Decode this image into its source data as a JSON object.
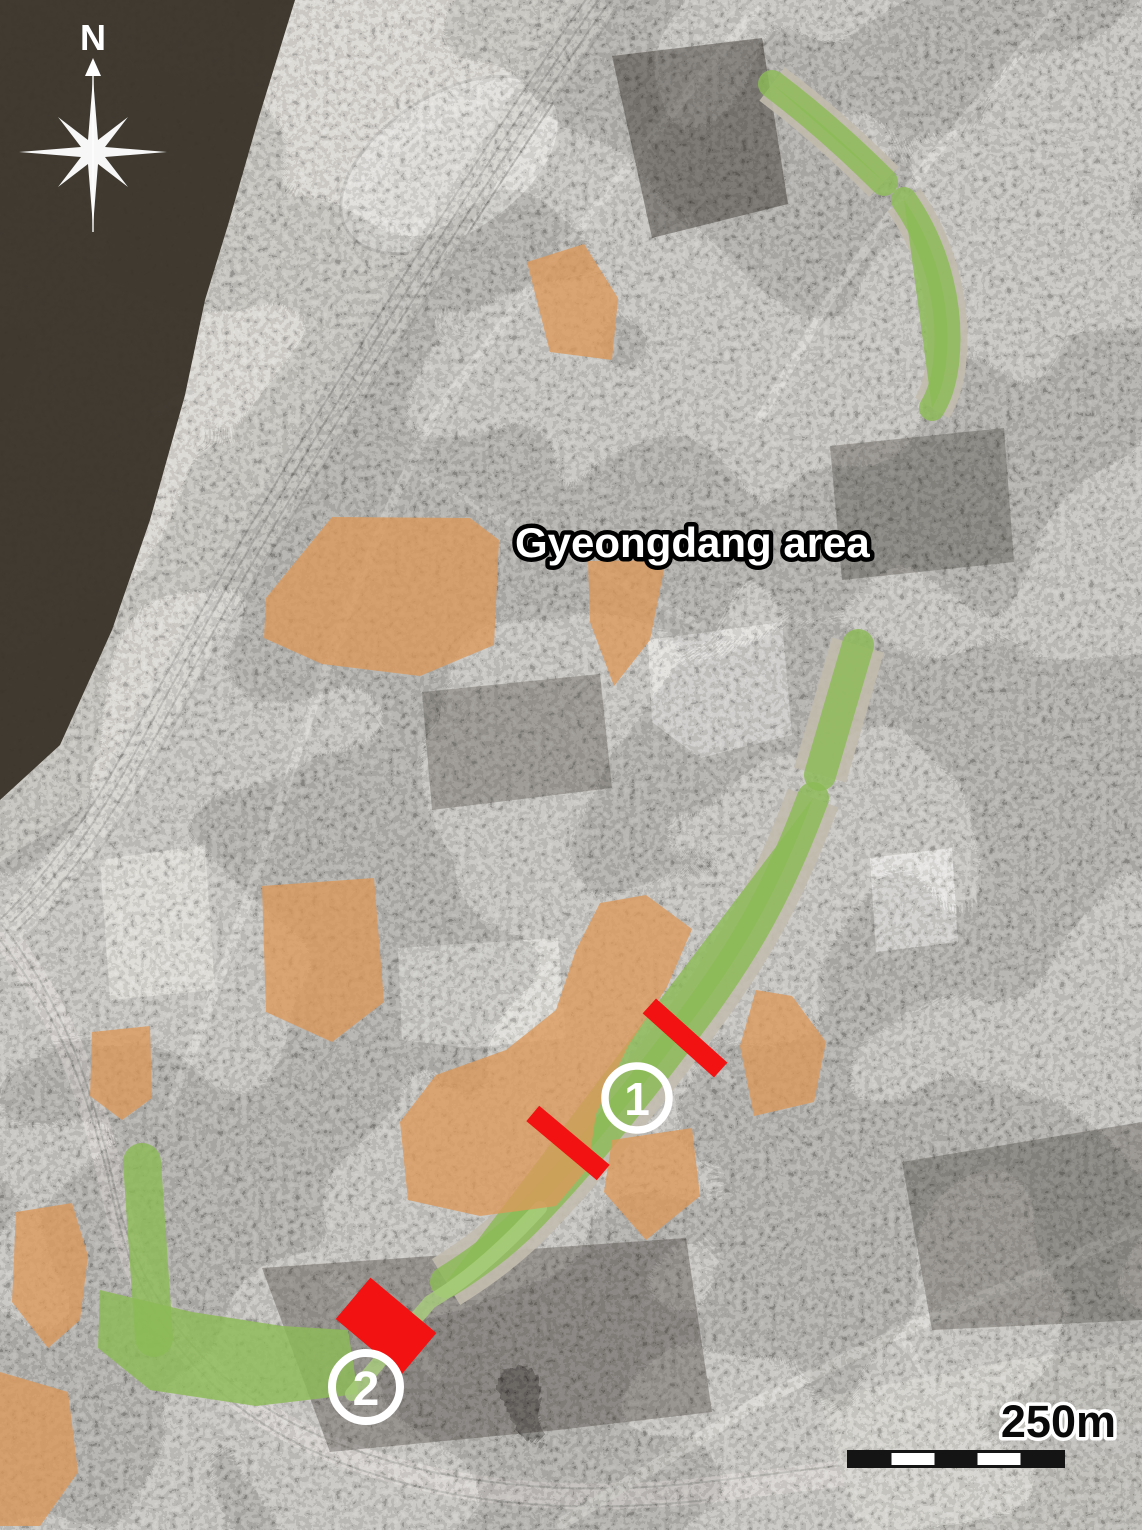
{
  "map": {
    "region_label": "Gyeongdang area",
    "compass": {
      "north_label": "N"
    },
    "scale_bar": {
      "label": "250m",
      "segment_count": 5
    },
    "markers": [
      {
        "label": "1"
      },
      {
        "label": "2"
      }
    ],
    "colors": {
      "highlight_orange": "#dc995a",
      "corridor_green": "#8cbb57",
      "corridor_green_light": "#a9ce7c",
      "marker_red": "#f31212",
      "water_dark": "#3a342b",
      "annotation_white": "#ffffff"
    }
  }
}
